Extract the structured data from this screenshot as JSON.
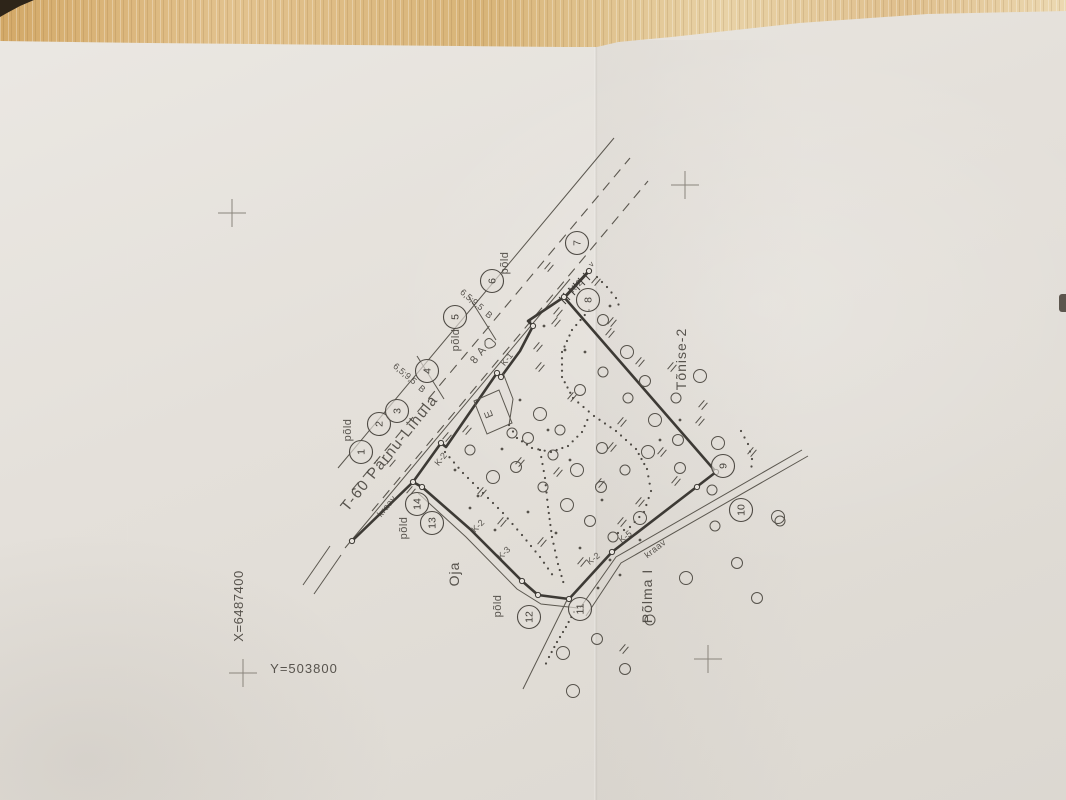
{
  "colors": {
    "wood": "#d9b67c",
    "paper": "#e3dfd9",
    "ink": "#45413b",
    "pencil": "#8a857c"
  },
  "grid": {
    "x_label": "X=6487400",
    "y_label": "Y=503800",
    "crosses": [
      [
        232,
        213
      ],
      [
        685,
        185
      ],
      [
        708,
        659
      ],
      [
        243,
        673
      ]
    ]
  },
  "labels": [
    {
      "name": "road-name",
      "text": "T-60 Pärnu-Lihula",
      "x": 393,
      "y": 456,
      "rot": -51,
      "size": 15,
      "ls": 1.5
    },
    {
      "name": "field-label-1",
      "text": "põld",
      "x": 351,
      "y": 430,
      "rot": -90,
      "size": 11,
      "ls": 0.5
    },
    {
      "name": "field-label-2",
      "text": "põld",
      "x": 459,
      "y": 340,
      "rot": -90,
      "size": 11,
      "ls": 0.5
    },
    {
      "name": "field-label-3",
      "text": "põld",
      "x": 508,
      "y": 263,
      "rot": -90,
      "size": 11,
      "ls": 0.5
    },
    {
      "name": "field-label-4",
      "text": "põld",
      "x": 407,
      "y": 528,
      "rot": -90,
      "size": 11,
      "ls": 0.5
    },
    {
      "name": "field-label-5",
      "text": "põld",
      "x": 501,
      "y": 606,
      "rot": -90,
      "size": 11,
      "ls": 0.5
    },
    {
      "name": "stream-name",
      "text": "Oja",
      "x": 459,
      "y": 574,
      "rot": -90,
      "size": 14,
      "ls": 1
    },
    {
      "name": "property-name-polma",
      "text": "Põlma I",
      "x": 652,
      "y": 596,
      "rot": -90,
      "size": 14,
      "ls": 1
    },
    {
      "name": "property-name-tonise",
      "text": "Tõnise-2",
      "x": 686,
      "y": 359,
      "rot": -90,
      "size": 14,
      "ls": 1
    },
    {
      "name": "grid-x-label",
      "text": "X=6487400",
      "x": 243,
      "y": 606,
      "rot": -90,
      "size": 13,
      "ls": 0.5
    },
    {
      "name": "grid-y-label",
      "text": "Y=503800",
      "x": 304,
      "y": 673,
      "rot": 0,
      "size": 13,
      "ls": 1
    },
    {
      "name": "road-width-note-1",
      "text": "6,5;9,5",
      "x": 403,
      "y": 376,
      "rot": 40,
      "size": 9,
      "ls": 0
    },
    {
      "name": "road-surface-note-1",
      "text": "B",
      "x": 420,
      "y": 391,
      "rot": 40,
      "size": 9,
      "ls": 0
    },
    {
      "name": "road-width-note-2",
      "text": "6,5;9,5",
      "x": 470,
      "y": 302,
      "rot": 40,
      "size": 9,
      "ls": 0
    },
    {
      "name": "road-surface-note-2",
      "text": "B",
      "x": 487,
      "y": 317,
      "rot": 40,
      "size": 9,
      "ls": 0
    },
    {
      "name": "road-lane-note",
      "text": "8 A",
      "x": 481,
      "y": 357,
      "rot": -51,
      "size": 11,
      "ls": 1
    },
    {
      "name": "ditch-label-k1",
      "text": "K-1",
      "x": 509,
      "y": 361,
      "rot": -51,
      "size": 9,
      "ls": 0
    },
    {
      "name": "ditch-label-k2-a",
      "text": "K-2",
      "x": 443,
      "y": 461,
      "rot": -51,
      "size": 9,
      "ls": 0
    },
    {
      "name": "ditch-label-k2-b",
      "text": "K-2",
      "x": 578,
      "y": 288,
      "rot": -45,
      "size": 9,
      "ls": 0
    },
    {
      "name": "ditch-label-k2-c",
      "text": "K-2",
      "x": 480,
      "y": 528,
      "rot": -45,
      "size": 9,
      "ls": 0
    },
    {
      "name": "ditch-label-k2-d",
      "text": "K-2",
      "x": 595,
      "y": 561,
      "rot": -38,
      "size": 9,
      "ls": 0
    },
    {
      "name": "ditch-label-k3",
      "text": "K-3",
      "x": 506,
      "y": 555,
      "rot": -45,
      "size": 9,
      "ls": 0
    },
    {
      "name": "ditch-label-k5",
      "text": "K-5",
      "x": 627,
      "y": 539,
      "rot": -38,
      "size": 9,
      "ls": 0
    },
    {
      "name": "ditch-text-kraav-1",
      "text": "kraav",
      "x": 389,
      "y": 508,
      "rot": -51,
      "size": 9,
      "ls": 0.5
    },
    {
      "name": "ditch-text-kraav-2",
      "text": "kraav",
      "x": 657,
      "y": 551,
      "rot": -38,
      "size": 9,
      "ls": 0.5
    },
    {
      "name": "culvert-note",
      "text": "v",
      "x": 593,
      "y": 266,
      "rot": -45,
      "size": 8,
      "ls": 0
    },
    {
      "name": "building-label",
      "text": "E",
      "x": 492,
      "y": 413,
      "rot": -112,
      "size": 11,
      "ls": 0
    }
  ],
  "boundary_points": [
    {
      "n": "1",
      "x": 361,
      "y": 452
    },
    {
      "n": "2",
      "x": 379,
      "y": 424
    },
    {
      "n": "3",
      "x": 397,
      "y": 411
    },
    {
      "n": "4",
      "x": 427,
      "y": 371
    },
    {
      "n": "5",
      "x": 455,
      "y": 317
    },
    {
      "n": "6",
      "x": 492,
      "y": 281
    },
    {
      "n": "7",
      "x": 577,
      "y": 243
    },
    {
      "n": "8",
      "x": 588,
      "y": 300
    },
    {
      "n": "9",
      "x": 723,
      "y": 466
    },
    {
      "n": "10",
      "x": 741,
      "y": 510
    },
    {
      "n": "11",
      "x": 580,
      "y": 609
    },
    {
      "n": "12",
      "x": 529,
      "y": 617
    },
    {
      "n": "13",
      "x": 432,
      "y": 523
    },
    {
      "n": "14",
      "x": 417,
      "y": 504
    }
  ],
  "symbols": {
    "trees": [
      [
        470,
        450
      ],
      [
        493,
        477
      ],
      [
        516,
        467
      ],
      [
        543,
        487
      ],
      [
        567,
        505
      ],
      [
        590,
        521
      ],
      [
        613,
        537
      ],
      [
        640,
        518
      ],
      [
        528,
        438
      ],
      [
        553,
        455
      ],
      [
        577,
        470
      ],
      [
        601,
        487
      ],
      [
        625,
        470
      ],
      [
        648,
        452
      ],
      [
        602,
        448
      ],
      [
        560,
        430
      ],
      [
        540,
        414
      ],
      [
        580,
        390
      ],
      [
        603,
        372
      ],
      [
        627,
        352
      ],
      [
        645,
        381
      ],
      [
        628,
        398
      ],
      [
        655,
        420
      ],
      [
        678,
        440
      ],
      [
        676,
        398
      ],
      [
        700,
        376
      ],
      [
        603,
        320
      ],
      [
        512,
        433
      ],
      [
        718,
        443
      ],
      [
        680,
        468
      ],
      [
        712,
        490
      ],
      [
        563,
        653
      ],
      [
        597,
        639
      ],
      [
        650,
        620
      ],
      [
        686,
        578
      ],
      [
        737,
        563
      ],
      [
        780,
        521
      ],
      [
        573,
        691
      ],
      [
        757,
        598
      ],
      [
        715,
        526
      ],
      [
        778,
        517
      ],
      [
        625,
        669
      ]
    ],
    "dots": [
      [
        455,
        470
      ],
      [
        478,
        496
      ],
      [
        502,
        449
      ],
      [
        528,
        512
      ],
      [
        556,
        533
      ],
      [
        580,
        548
      ],
      [
        610,
        560
      ],
      [
        640,
        540
      ],
      [
        602,
        500
      ],
      [
        570,
        460
      ],
      [
        548,
        430
      ],
      [
        520,
        400
      ],
      [
        585,
        352
      ],
      [
        660,
        440
      ],
      [
        680,
        420
      ],
      [
        495,
        530
      ],
      [
        470,
        508
      ],
      [
        620,
        575
      ],
      [
        598,
        588
      ],
      [
        544,
        326
      ],
      [
        610,
        306
      ],
      [
        565,
        350
      ]
    ],
    "grass": [
      [
        391,
        462
      ],
      [
        411,
        491
      ],
      [
        447,
        437
      ],
      [
        467,
        430
      ],
      [
        538,
        347
      ],
      [
        556,
        322
      ],
      [
        540,
        367
      ],
      [
        610,
        333
      ],
      [
        640,
        362
      ],
      [
        622,
        422
      ],
      [
        520,
        462
      ],
      [
        558,
        472
      ],
      [
        600,
        483
      ],
      [
        640,
        502
      ],
      [
        662,
        452
      ],
      [
        482,
        492
      ],
      [
        502,
        522
      ],
      [
        542,
        542
      ],
      [
        582,
        562
      ],
      [
        622,
        522
      ],
      [
        676,
        481
      ],
      [
        700,
        421
      ],
      [
        572,
        397
      ],
      [
        612,
        447
      ],
      [
        596,
        281
      ],
      [
        558,
        312
      ],
      [
        612,
        322
      ],
      [
        752,
        452
      ],
      [
        624,
        649
      ],
      [
        672,
        367
      ],
      [
        703,
        405
      ],
      [
        549,
        267
      ]
    ],
    "vertex_markers": [
      [
        441,
        443
      ],
      [
        497,
        373
      ],
      [
        533,
        326
      ],
      [
        564,
        297
      ],
      [
        589,
        271
      ],
      [
        716,
        472
      ],
      [
        697,
        487
      ],
      [
        612,
        552
      ],
      [
        569,
        599
      ],
      [
        538,
        595
      ],
      [
        522,
        581
      ],
      [
        422,
        487
      ],
      [
        413,
        482
      ],
      [
        352,
        541
      ],
      [
        501,
        377
      ]
    ]
  },
  "dotted_ditches": [
    [
      [
        509,
        425
      ],
      [
        517,
        438
      ],
      [
        532,
        448
      ],
      [
        551,
        452
      ],
      [
        568,
        446
      ],
      [
        582,
        432
      ],
      [
        590,
        414
      ]
    ],
    [
      [
        589,
        310
      ],
      [
        572,
        330
      ],
      [
        562,
        352
      ],
      [
        562,
        377
      ],
      [
        573,
        398
      ],
      [
        594,
        416
      ],
      [
        616,
        431
      ],
      [
        636,
        449
      ],
      [
        647,
        469
      ],
      [
        651,
        491
      ],
      [
        644,
        512
      ],
      [
        630,
        527
      ],
      [
        612,
        536
      ]
    ],
    [
      [
        540,
        450
      ],
      [
        545,
        478
      ],
      [
        548,
        507
      ],
      [
        552,
        537
      ],
      [
        558,
        564
      ],
      [
        565,
        588
      ]
    ],
    [
      [
        445,
        452
      ],
      [
        463,
        473
      ],
      [
        483,
        493
      ],
      [
        503,
        513
      ],
      [
        522,
        535
      ],
      [
        540,
        557
      ],
      [
        556,
        580
      ]
    ],
    [
      [
        574,
        612
      ],
      [
        566,
        627
      ],
      [
        557,
        642
      ],
      [
        549,
        657
      ],
      [
        543,
        670
      ]
    ],
    [
      [
        741,
        431
      ],
      [
        748,
        444
      ],
      [
        752,
        459
      ],
      [
        751,
        474
      ]
    ],
    [
      [
        597,
        277
      ],
      [
        607,
        287
      ],
      [
        616,
        298
      ],
      [
        621,
        311
      ]
    ]
  ]
}
